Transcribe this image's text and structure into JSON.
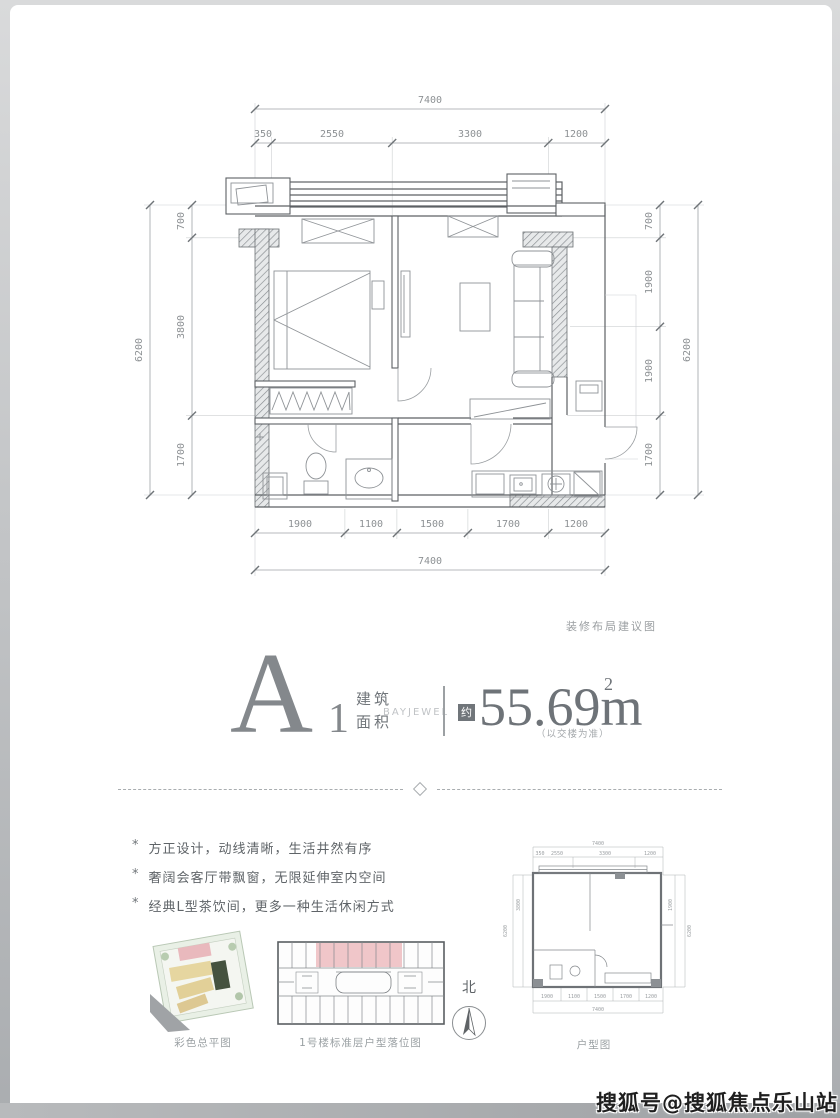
{
  "page": {
    "watermark": "搜狐号@搜狐焦点乐山站"
  },
  "plan": {
    "note": "装修布局建议图",
    "dims": {
      "top_total": "7400",
      "top": [
        "350",
        "2550",
        "3300",
        "1200"
      ],
      "bottom": [
        "1900",
        "1100",
        "1500",
        "1700",
        "1200"
      ],
      "bottom_total": "7400",
      "left": [
        "700",
        "3800",
        "1700"
      ],
      "left_total": "6200",
      "right": [
        "700",
        "1900",
        "1900",
        "1700"
      ],
      "right_total": "6200"
    }
  },
  "unit": {
    "name": "A",
    "number": "1",
    "area_label_line1": "建筑",
    "area_label_line2": "面积",
    "brand": "BAYJEWEL",
    "approx": "约",
    "area_value": "55.69m",
    "area_sup": "2",
    "area_note": "（以交楼为准）"
  },
  "features": {
    "marker": "*",
    "items": [
      "方正设计，动线清晰，生活井然有序",
      "奢阔会客厅带飘窗，无限延伸室内空间",
      "经典L型茶饮间，更多一种生活休闲方式"
    ]
  },
  "thumbnails": {
    "site_plan_caption": "彩色总平图",
    "floor_plan_caption": "1号楼标准层户型落位图",
    "unit_plan_caption": "户型图",
    "north_label": "北"
  },
  "colors": {
    "highlight_pink": "#f0c6c9",
    "site_yellow": "#e6d6a0",
    "site_green": "#dde9da",
    "wall_gray": "#5d6165",
    "watermark_bar": "#a7a9ac"
  }
}
